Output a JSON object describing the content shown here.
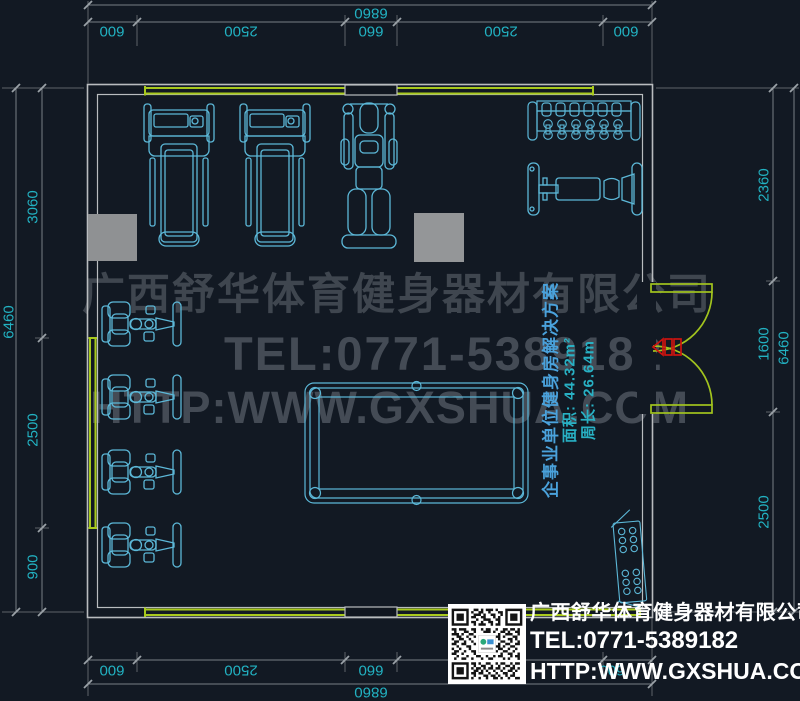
{
  "drawing": {
    "type": "cad-gym-floor-plan",
    "background": "#121923"
  },
  "dimensions": {
    "top": {
      "segments": [
        "600",
        "2500",
        "660",
        "2500",
        "600"
      ],
      "total": "6860"
    },
    "bottom": {
      "segments": [
        "600",
        "2500",
        "660",
        "2500",
        "600"
      ],
      "total": "6860"
    },
    "left": {
      "segments": [
        "3060",
        "2500",
        "900"
      ],
      "total": "6460"
    },
    "right": {
      "segments": [
        "2360",
        "1600",
        "2500"
      ],
      "total": "6460"
    }
  },
  "watermark": {
    "company": "广西舒华体育健身器材有限公司",
    "tel": "TEL:0771-5389182",
    "website": "HTTP:WWW.GXSHUA.COM"
  },
  "solution_note": {
    "title": "企事业单位健身房解决方案",
    "area": "面积: 44.32m²",
    "perimeter": "周长: 26.64m"
  },
  "footer": {
    "company": "广西舒华体育健身器材有限公司",
    "tel": "TEL:0771-5389182",
    "website": "HTTP:WWW.GXSHUA.COM"
  },
  "equipment_items": [
    "treadmill",
    "treadmill",
    "multi-station-machine",
    "dumbbell-rack",
    "flat-bench",
    "strength-machine",
    "strength-machine",
    "strength-machine",
    "strength-machine",
    "billiard-table",
    "plate-rack",
    "double-swing-door"
  ],
  "colors": {
    "background": "#121923",
    "equipment_line": "#5cb8d8",
    "wall_line": "#b9bcbf",
    "window_line": "#a8c91d",
    "door_line": "#a2c41e",
    "door_marker": "#cc1410",
    "dimension_line": "#787e84",
    "dimension_text": "#22b2c2",
    "column_fill": "#8f9193",
    "watermark_text": "#3f464f",
    "footer_text": "#ffffff",
    "note_title": "#4aa2dc",
    "note_value": "#28b1c4"
  }
}
